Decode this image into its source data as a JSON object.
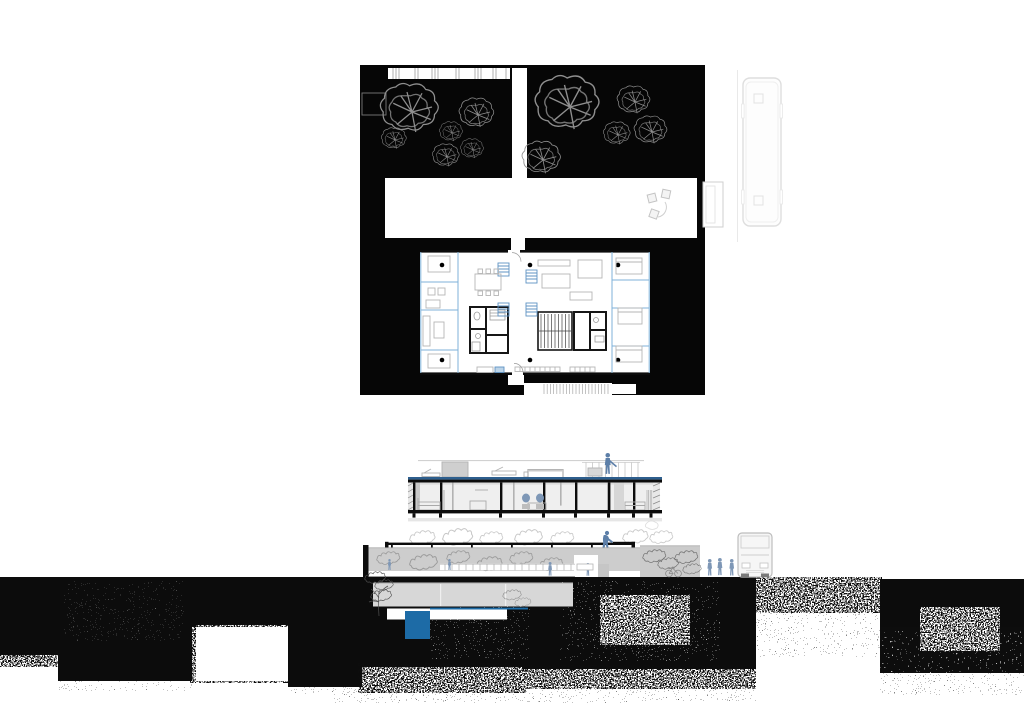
{
  "sheet": {
    "kind": "architectural-presentation-sheet",
    "views": [
      "site-plan-figure-ground",
      "floor-plan",
      "cross-section",
      "street-elevation",
      "charcoal-ground-texture"
    ]
  },
  "colors": {
    "paper": "#ffffff",
    "ink": "#0c0c0c",
    "site_black": "#060606",
    "tree_line": "#8f8f8f",
    "plan_blue": "#7fb2d9",
    "shaft_blue": "#5f93c3",
    "roof_blue": "#2e5f8e",
    "pool_blue": "#1d6ba6",
    "figure_blue": "#7e97b6",
    "figure_blue_dark": "#5d7fa8",
    "light_gray": "#cdcdcd",
    "mid_gray": "#9a9a9a",
    "faint_gray": "#e3e3e3"
  },
  "site_plan": {
    "trees": 11,
    "structural_columns": 6,
    "vent_shafts": 4
  },
  "section": {
    "roof_figures": 1,
    "blue_chairs": 2
  },
  "elevation": {
    "figures": 7,
    "buses": 1,
    "bicycles": 1,
    "pools": 1
  }
}
